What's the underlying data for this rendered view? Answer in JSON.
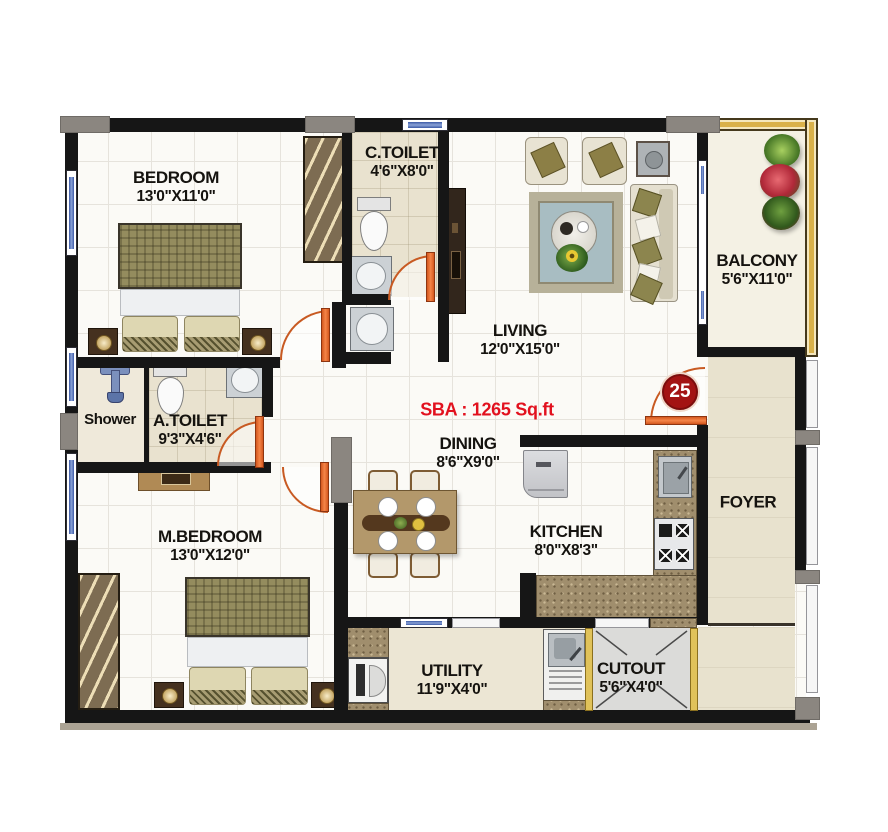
{
  "plan": {
    "sba_label": "SBA : 1265 Sq.ft",
    "unit_number": "25",
    "rooms": {
      "bedroom": {
        "name": "BEDROOM",
        "dims": "13'0\"X11'0\""
      },
      "ctoilet": {
        "name": "C.TOILET",
        "dims": "4'6\"X8'0\""
      },
      "living": {
        "name": "LIVING",
        "dims": "12'0\"X15'0\""
      },
      "balcony": {
        "name": "BALCONY",
        "dims": "5'6\"X11'0\""
      },
      "shower": {
        "name": "Shower"
      },
      "atoilet": {
        "name": "A.TOILET",
        "dims": "9'3\"X4'6\""
      },
      "dining": {
        "name": "DINING",
        "dims": "8'6\"X9'0\""
      },
      "mbedroom": {
        "name": "M.BEDROOM",
        "dims": "13'0\"X12'0\""
      },
      "kitchen": {
        "name": "KITCHEN",
        "dims": "8'0\"X8'3\""
      },
      "foyer": {
        "name": "FOYER"
      },
      "utility": {
        "name": "UTILITY",
        "dims": "11'9\"X4'0\""
      },
      "cutout": {
        "name": "CUTOUT",
        "dims": "5'6\"X4'0\""
      }
    },
    "colors": {
      "wall": "#161616",
      "door": "#ee6a2e",
      "window_glass": "#5577bb",
      "balcony_rail": "#d9b14a",
      "sba_text": "#e2111e",
      "unit_badge": "#a31313",
      "floor_tile": "#fbfaf6",
      "bath_floor": "#e9e2cf",
      "foyer_floor": "#e8e2ce",
      "granite": "#a08e6d"
    }
  }
}
